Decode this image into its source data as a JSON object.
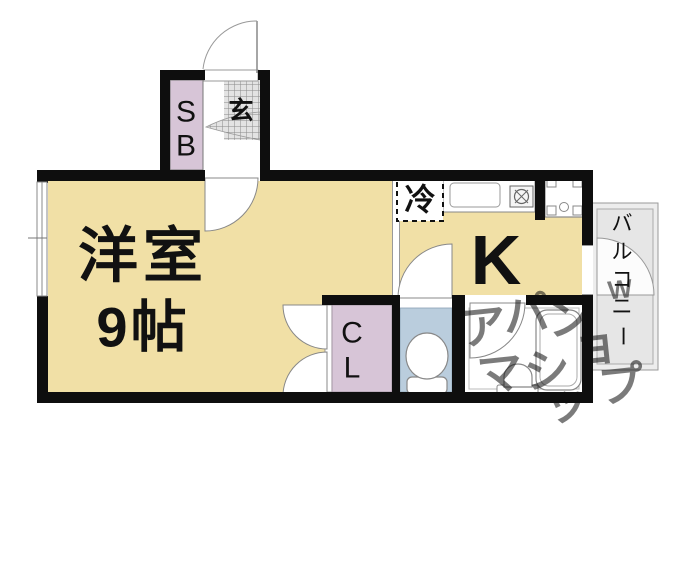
{
  "plan": {
    "title": "apartment-floor-plan",
    "labels": {
      "room_line1": "洋室",
      "room_line2": "9帖",
      "kitchen": "K",
      "fridge": "冷",
      "entrance": "玄",
      "shoebox": [
        "S",
        "B"
      ],
      "closet": [
        "C",
        "L"
      ],
      "balcony": [
        "バ",
        "ル",
        "コ",
        "ニ",
        "ー"
      ]
    },
    "watermark": {
      "chars": [
        "ア",
        "パ",
        "マ",
        "ン",
        "シ",
        "ョ",
        "ッ",
        "プ"
      ],
      "w_mark": "W"
    },
    "colors": {
      "room": "#F1E0A6",
      "closet": "#D7C5D7",
      "shoebox": "#D7C5D7",
      "toilet": "#BACDDD",
      "balcony": "#EDEDED",
      "balcony_inner": "#E6E6E6",
      "tile": "#E3E3E3",
      "wall": "#0E0E0E",
      "watermark": "#CDCDCD"
    }
  }
}
